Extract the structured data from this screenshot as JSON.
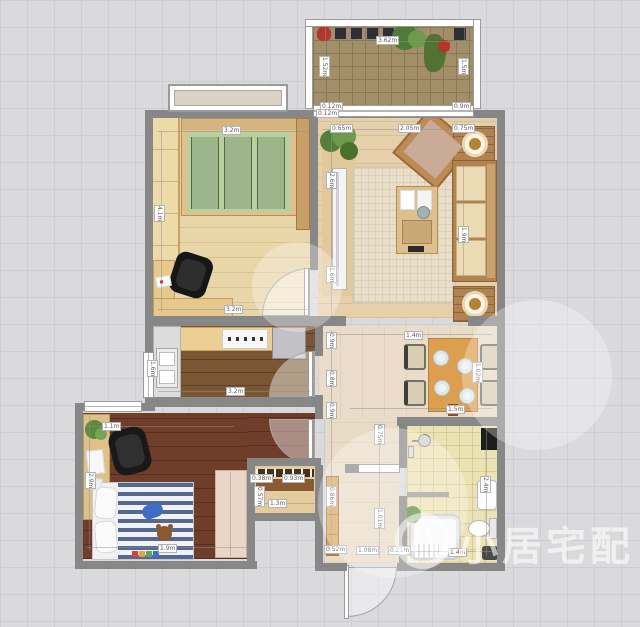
{
  "watermark": {
    "text": "小居宅配"
  },
  "palette": {
    "wall": "#878787",
    "wood_light": "#e9d6a8",
    "wood_dark": "#6f3d2a",
    "kitchen_floor": "#7b5634",
    "living_floor": "#e6d0ab",
    "hall_floor": "#eadcc8",
    "bath_floor": "#ece3b4",
    "balcony_tile": "#a28e68",
    "bed_green": "#b9cf9f",
    "bed_stripe_blue": "#55688f",
    "dining_table": "#dc9f50",
    "grid_bg": "#dadadd"
  },
  "dims": {
    "balcony_w": "3.62m",
    "balcony_l": "1.52m",
    "balcony_r": "1.5m",
    "balcony_s1": "0.12m",
    "balcony_s2": "0.9m",
    "b1_top": "3.2m",
    "b1_left": "4.1m",
    "b1_bottom": "3.2m",
    "k_left": "1.6m",
    "k_bottom": "3.2m",
    "lr_top1": "0.65m",
    "lr_top2": "2.05m",
    "lr_top3": "0.75m",
    "lr_corner": "0.12m",
    "lr_left1": "2.6m",
    "lr_left2": "1.6m",
    "sofa_len": "1.9m",
    "dn_top": "1.4m",
    "dn_bottom": "1.5m",
    "dn_right": "1.02m",
    "wall_v1": "0.9m",
    "wall_v2": "0.8m",
    "wall_v3": "0.9m",
    "hall_v1": "0.75m",
    "hall_v2": "1.01m",
    "hall_v3": "0.86m",
    "hall_b1": "0.52m",
    "hall_b2": "1.08m",
    "hall_b3": "0.21m",
    "bath_right": "2.4m",
    "bath_bottom": "1.4m",
    "closet_w1": "0.38m",
    "closet_w2": "0.93m",
    "closet_w3": "1.3m",
    "closet_v": "0.57m",
    "b2_top": "1.1m",
    "b2_left": "2.9m",
    "b2_bottom": "1.9m"
  }
}
